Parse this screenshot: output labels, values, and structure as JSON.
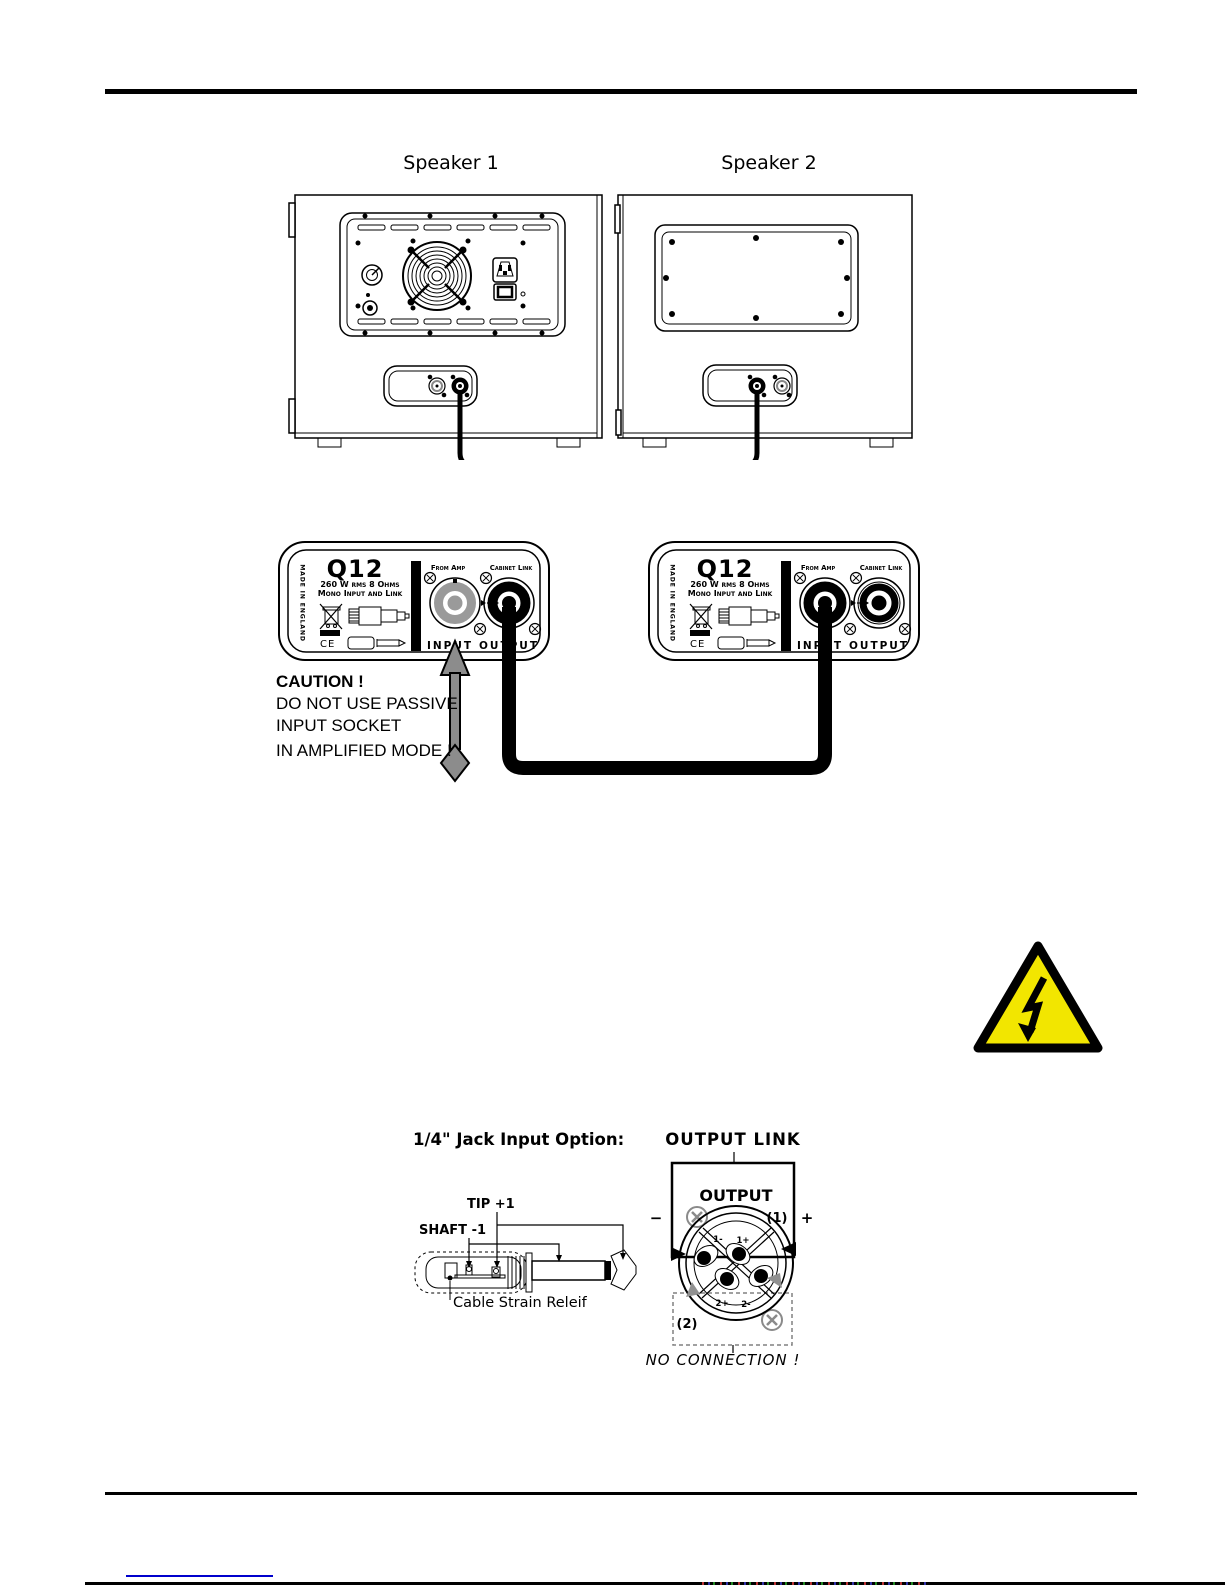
{
  "speakers": {
    "label1": "Speaker 1",
    "label2": "Speaker 2"
  },
  "panel": {
    "model": "Q12",
    "spec": "260 W rms 8 Ohms",
    "mono": "Mono Input and Link",
    "made_in": "MADE IN ENGLAND",
    "bar": "1/4\" JACK & SPEAKON",
    "ce": "CE",
    "from_amp": "From Amp",
    "cabinet_link": "Cabinet Link",
    "input": "INPUT",
    "output": "OUTPUT"
  },
  "caution": {
    "title": "CAUTION !",
    "line1": "DO NOT USE PASSIVE",
    "line2": "INPUT SOCKET",
    "line3": "IN AMPLIFIED MODE !"
  },
  "jack_option": {
    "title": "1/4\" Jack Input Option:",
    "tip": "TIP +1",
    "shaft": "SHAFT -1",
    "strain": "Cable Strain Releif"
  },
  "output_link": {
    "title": "OUTPUT LINK",
    "output": "OUTPUT",
    "minus": "−",
    "plus": "+",
    "s1": "(1)",
    "s2": "(2)",
    "terminals": [
      "1-",
      "1+",
      "2+",
      "2-"
    ],
    "no_connection": "NO CONNECTION !"
  },
  "colors": {
    "warning_yellow": "#f2e600",
    "arrow_gray": "#8c8c8c",
    "link_blue": "#0000cc",
    "muted_gray": "#8f8f8f"
  }
}
